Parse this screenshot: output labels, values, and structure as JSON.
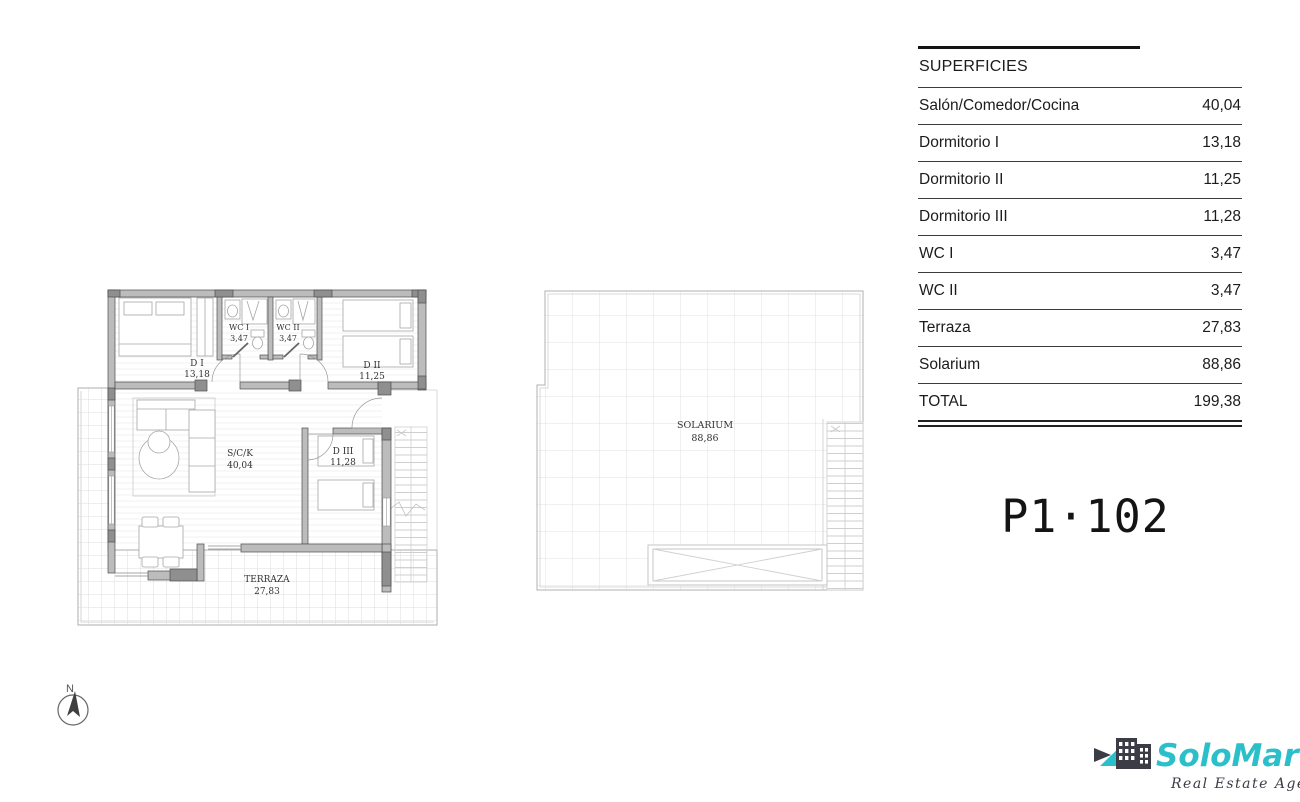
{
  "table": {
    "title": "SUPERFICIES",
    "rows": [
      {
        "label": "Salón/Comedor/Cocina",
        "value": "40,04"
      },
      {
        "label": "Dormitorio I",
        "value": "13,18"
      },
      {
        "label": "Dormitorio II",
        "value": "11,25"
      },
      {
        "label": "Dormitorio III",
        "value": "11,28"
      },
      {
        "label": "WC I",
        "value": "3,47"
      },
      {
        "label": "WC II",
        "value": "3,47"
      },
      {
        "label": "Terraza",
        "value": "27,83"
      },
      {
        "label": "Solarium",
        "value": "88,86"
      },
      {
        "label": "TOTAL",
        "value": "199,38"
      }
    ]
  },
  "unit_label": "P1·102",
  "floor_plan": {
    "rooms": [
      {
        "name": "D I",
        "area": "13,18"
      },
      {
        "name": "WC I",
        "area": "3,47"
      },
      {
        "name": "WC II",
        "area": "3,47"
      },
      {
        "name": "D II",
        "area": "11,25"
      },
      {
        "name": "S/C/K",
        "area": "40,04"
      },
      {
        "name": "D III",
        "area": "11,28"
      },
      {
        "name": "TERRAZA",
        "area": "27,83"
      }
    ]
  },
  "solarium_plan": {
    "name": "SOLARIUM",
    "area": "88,86"
  },
  "compass": {
    "label": "N"
  },
  "logo": {
    "name": "SoloMar",
    "tagline": "Real Estate Agency",
    "brand_teal": "#2BC0C9",
    "brand_dark": "#3C3C46"
  }
}
